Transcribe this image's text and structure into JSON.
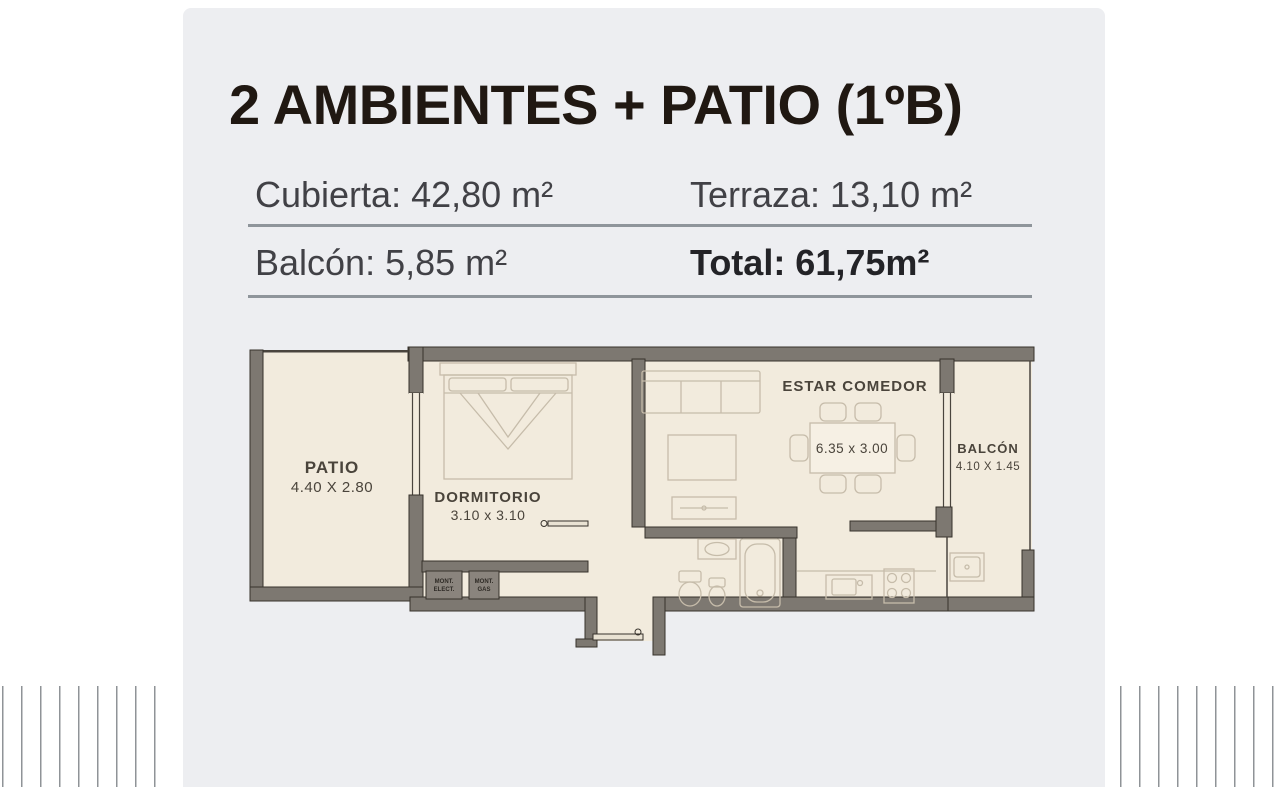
{
  "header": {
    "title": "2 AMBIENTES + PATIO (1ºB)",
    "rows": [
      {
        "left": "Cubierta: 42,80 m²",
        "right": "Terraza: 13,10 m²"
      },
      {
        "left": "Balcón: 5,85 m²",
        "right": "Total: 61,75m²"
      }
    ]
  },
  "floorplan": {
    "rooms": [
      {
        "name": "PATIO",
        "dims": "4.40 X 2.80"
      },
      {
        "name": "DORMITORIO",
        "dims": "3.10 x 3.10"
      },
      {
        "name": "ESTAR COMEDOR",
        "dims": "6.35 x 3.00"
      },
      {
        "name": "BALCÓN",
        "dims": "4.10 X 1.45"
      }
    ],
    "service_boxes": [
      {
        "line1": "MONT.",
        "line2": "ELECT."
      },
      {
        "line1": "MONT.",
        "line2": "GAS"
      }
    ],
    "colors": {
      "wall": "#7d7871",
      "wall_outline": "#37322c",
      "room_fill": "#f2ebdd",
      "furniture": "#c6bcaa",
      "label": "#4a443b",
      "card_bg": "#edeef1",
      "divider": "#8f959b"
    }
  }
}
